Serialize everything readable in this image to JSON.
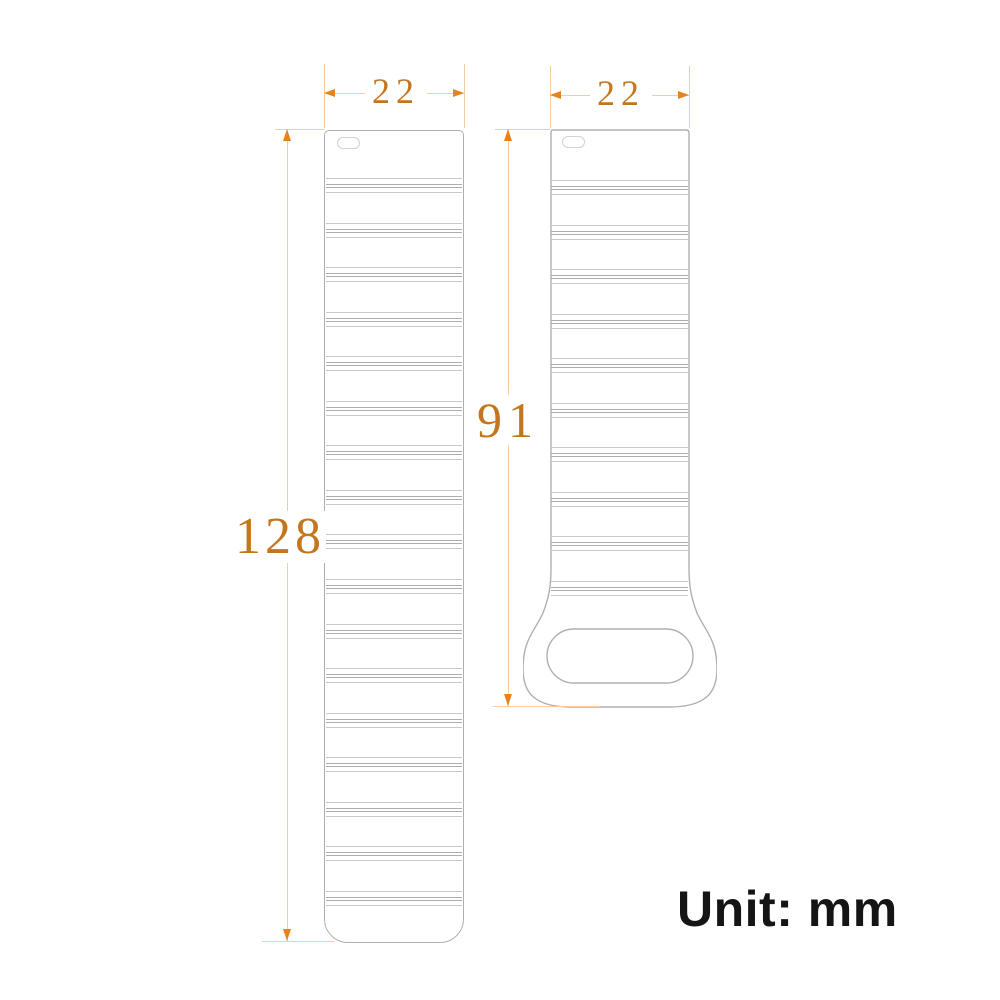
{
  "title": "Watch strap dimension diagram",
  "unit_note": {
    "label": "Unit: mm"
  },
  "colors": {
    "dimension_text": "#c4761f",
    "dimension_arrow": "#e8821c",
    "dimension_line": "#f3cba4",
    "strap_outline": "#b0b0b4",
    "background": "#ffffff",
    "unit_text": "#151515"
  },
  "straps": [
    {
      "id": "long-strap",
      "width_mm": 22,
      "length_mm": 128,
      "ridge_groups": 17,
      "features": [
        "spring-bar-slot"
      ]
    },
    {
      "id": "short-strap",
      "width_mm": 22,
      "length_mm": 91,
      "ridge_groups": 10,
      "features": [
        "spring-bar-slot",
        "buckle-loop-hole"
      ]
    }
  ],
  "dimension_labels": {
    "long_width": "22",
    "short_width": "22",
    "long_length": "128",
    "short_length": "91"
  }
}
